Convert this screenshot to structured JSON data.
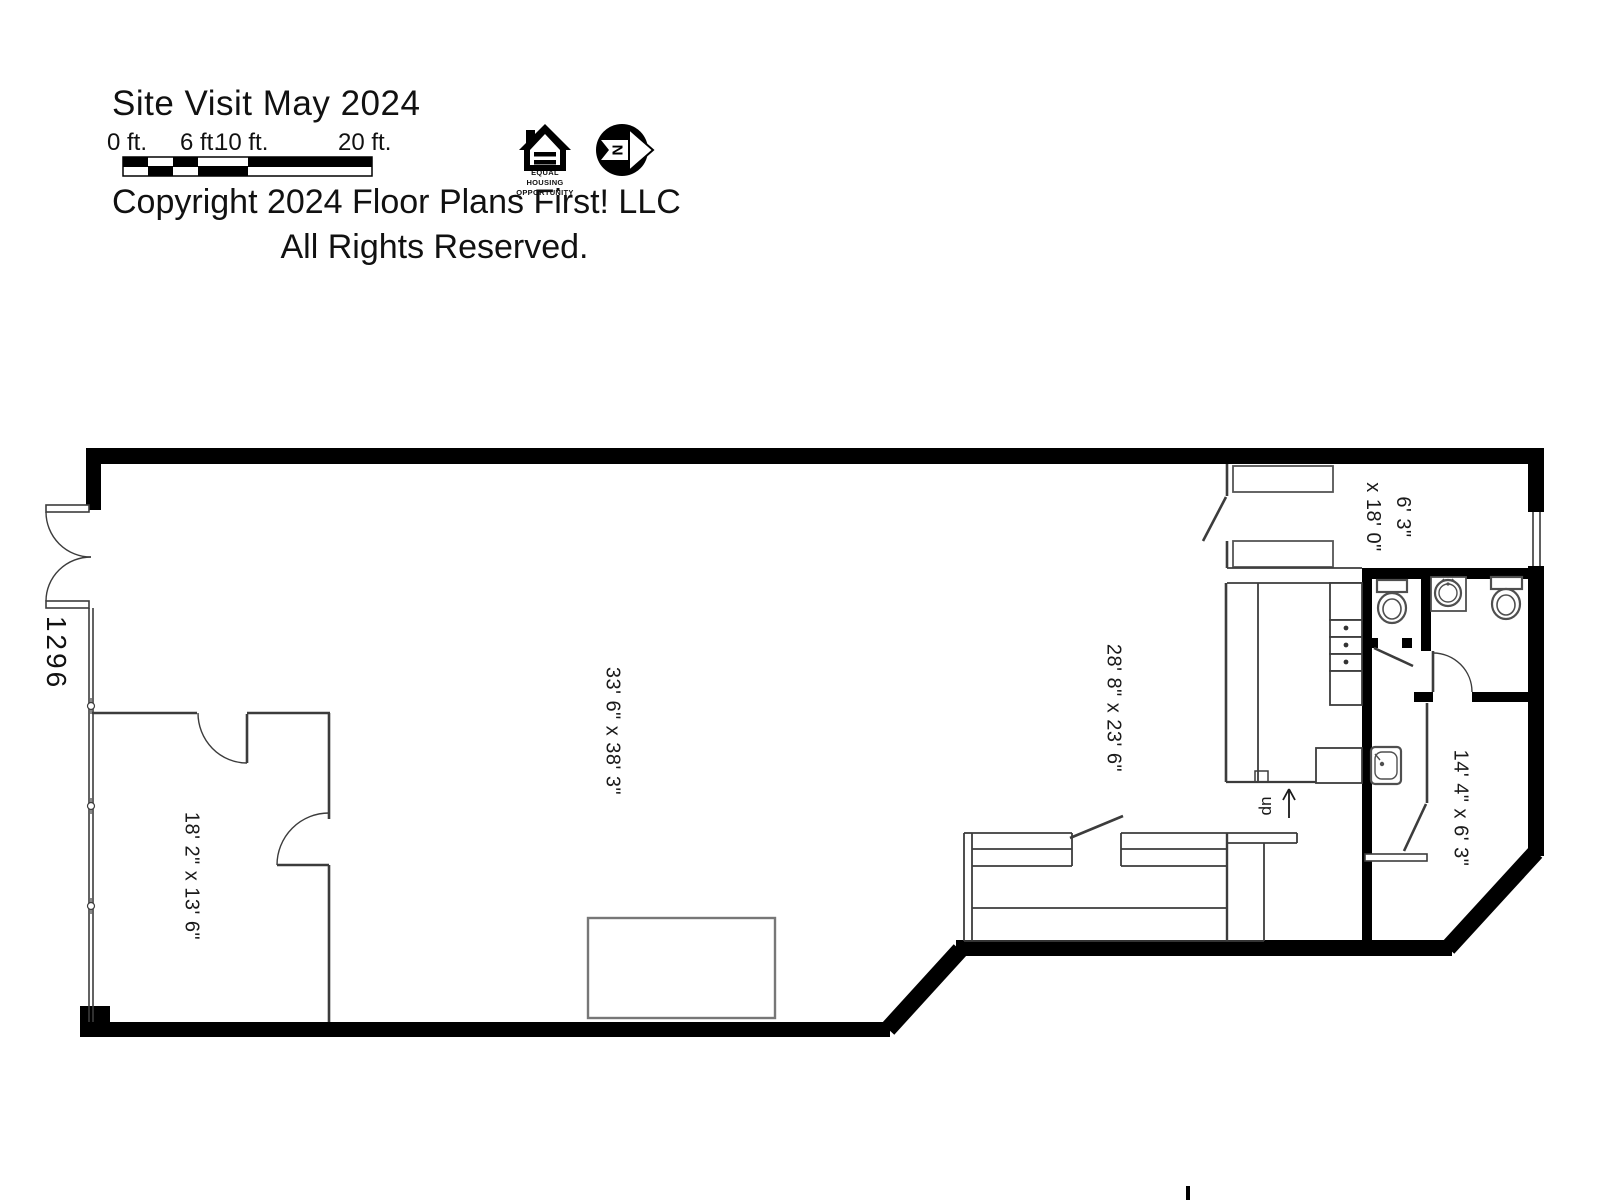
{
  "header": {
    "title": "Site Visit May 2024",
    "copyright_line1": "Copyright 2024 Floor Plans First! LLC",
    "copyright_line2": "All Rights Reserved.",
    "scale_bar": {
      "labels": [
        "0 ft.",
        "6 ft.",
        "10 ft.",
        "20 ft."
      ]
    },
    "equal_housing_logo": {
      "caption": "EQUAL\nHOUSING\nOPPORTUNITY"
    },
    "north_arrow": {
      "letter": "N"
    }
  },
  "floorplan": {
    "address": "1296",
    "room_labels": {
      "main_area": "33' 6\" x 38' 3\"",
      "rear_area": "28' 8\" x 23' 6\"",
      "front_room": "18' 2\" x 13' 6\"",
      "storage_room": "6' 3\"\nx 18' 0\"",
      "hallway": "14' 4\" x 6' 3\"",
      "stair_label": "up"
    },
    "colors": {
      "wall": "#000000",
      "partition": "#3c3c3c",
      "fixture": "#4f4f4f"
    }
  }
}
